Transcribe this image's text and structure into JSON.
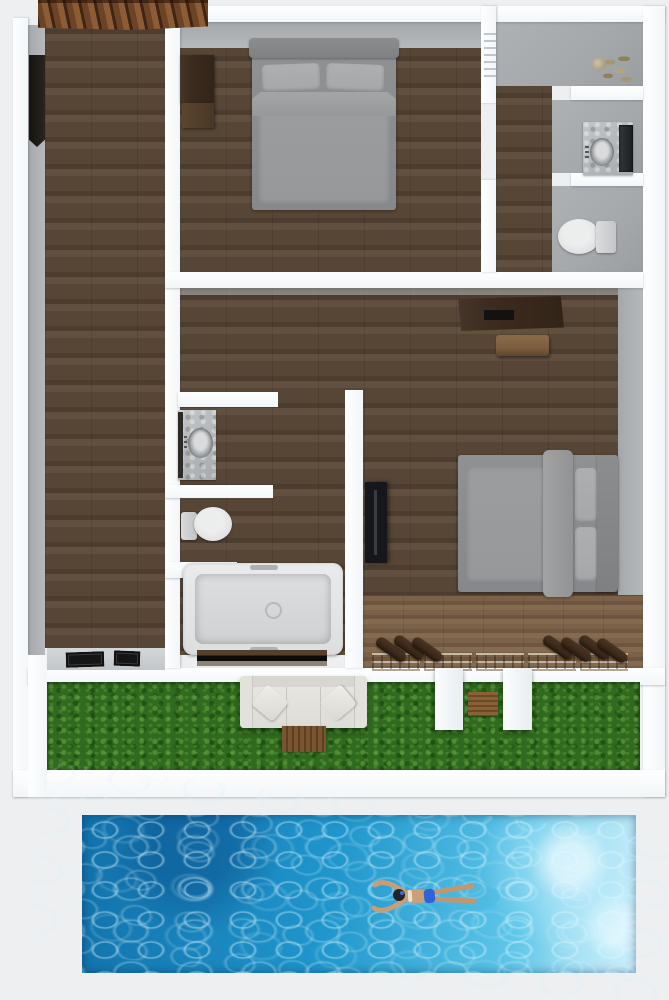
{
  "title": "Top-down 3D floor plan rendering of a two-bedroom villa with garden strip and swimming pool",
  "palette": {
    "bg": "#edeff1",
    "wall_white": "#f3f6f8",
    "wall_hi": "#fbfdfe",
    "wall_face": "#a5a8ab",
    "wood_dark": "#574636",
    "wood_dark2": "#4d3d2e",
    "wood_dark3": "#61503f",
    "deck": "#7a6148",
    "deck2": "#6f5640",
    "deck3": "#846a4e",
    "roof_beam": "#6b4325",
    "roof_gap": "#402513",
    "roof_light": "#8c5c35",
    "furn_dark": "#3c2c1f",
    "furn_mid": "#7c5e40",
    "gray_bed": "#96989a",
    "gray_bed_dark": "#86888b",
    "gray_pillow": "#a5a7a9",
    "white_fix": "#e0e2e3",
    "marble": "#b6b9bc",
    "tv": "#15171a",
    "grass": "#2f6a1e",
    "mat_brown": "#7a5532",
    "lounger": "#3a291a",
    "lounger_frame": "#c9bba6",
    "pool_deep": "#1271ab",
    "pool_mid": "#1f96cc",
    "pool_light": "#5ec6e9",
    "pool_foam": "#d6f3fc",
    "skin": "#c79e77",
    "hair": "#23242a",
    "bikini": "#2f62d8",
    "threshold": "#563f2b"
  },
  "scene": {
    "floorplan": {
      "rooms": [
        {
          "name": "left-corridor-room",
          "floor": "dark wood"
        },
        {
          "name": "bedroom-top",
          "floor": "dark wood",
          "furniture": [
            "double-bed",
            "wardrobe"
          ]
        },
        {
          "name": "bathroom-top-right",
          "floor": "gray tile",
          "furniture": [
            "plant",
            "sink-vanity-with-mirror",
            "toilet"
          ]
        },
        {
          "name": "living-area",
          "floor": "dark wood",
          "furniture": [
            "console-table",
            "stool",
            "wall-tv"
          ]
        },
        {
          "name": "bedroom-right",
          "floor": "dark wood",
          "furniture": [
            "double-bed"
          ]
        },
        {
          "name": "bathroom-left",
          "floor": "dark wood",
          "furniture": [
            "sink-vanity",
            "toilet",
            "bathtub"
          ]
        },
        {
          "name": "rear-deck",
          "floor": "light wood",
          "furniture": [
            "sun-loungers-with-rolled-cushions"
          ]
        }
      ],
      "details": [
        "timber-roof-corner-top-left",
        "dark-window-on-left-wall",
        "door-mats-bottom-left",
        "towel-ladder-on-wall"
      ]
    },
    "garden": {
      "ground": "lawn grass strip",
      "furniture": [
        "white-outdoor-sofa",
        "wooden-mat-below-sofa",
        "wooden-mat-between-pillars",
        "two-white-pillars"
      ]
    },
    "pool": {
      "water": "blue rippled water, brighter at right end",
      "swimmer": "person swimming face-down with arms swept back, dark hair, blue swimsuit"
    }
  }
}
